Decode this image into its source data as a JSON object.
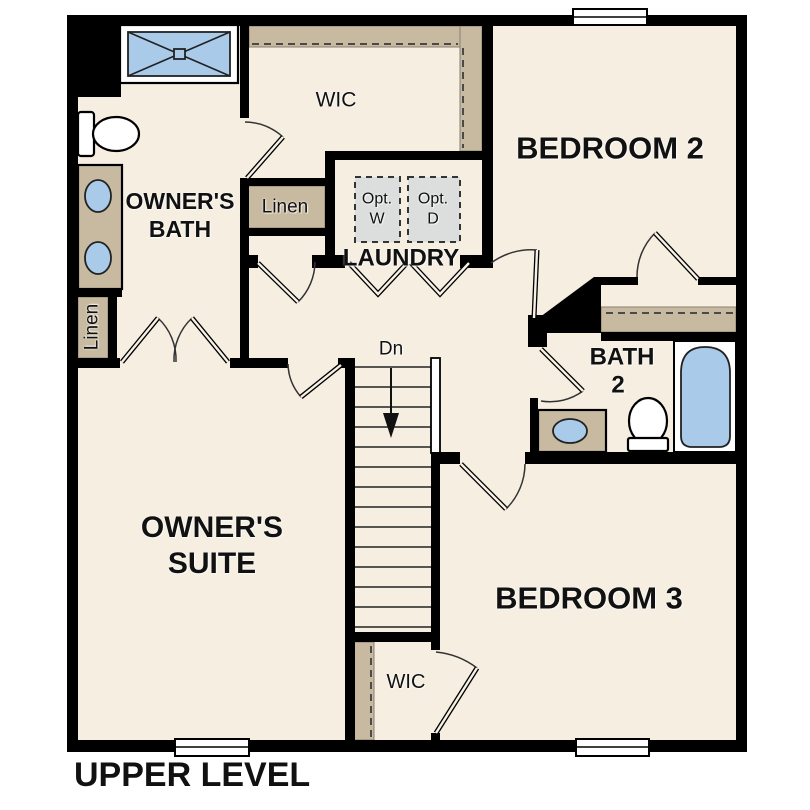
{
  "floor_plan": {
    "level_title": "UPPER LEVEL",
    "rooms": {
      "bedroom2": {
        "label": "BEDROOM 2"
      },
      "bedroom3": {
        "label": "BEDROOM 3"
      },
      "owners_suite": {
        "line1": "OWNER'S",
        "line2": "SUITE"
      },
      "owners_bath": {
        "line1": "OWNER'S",
        "line2": "BATH"
      },
      "bath2": {
        "line1": "BATH",
        "line2": "2"
      },
      "laundry": {
        "label": "LAUNDRY"
      },
      "wic_upper": {
        "label": "WIC"
      },
      "wic_lower": {
        "label": "WIC"
      },
      "linen_upper": {
        "label": "Linen"
      },
      "linen_lower": {
        "label": "Linen"
      }
    },
    "appliances": {
      "optional_washer": {
        "line1": "Opt.",
        "line2": "W"
      },
      "optional_dryer": {
        "line1": "Opt.",
        "line2": "D"
      }
    },
    "stairs": {
      "direction_label": "Dn"
    },
    "fixtures": [
      "shower",
      "toilet",
      "double-sink-vanity",
      "linen-shelves",
      "optional-washer-dryer",
      "sink-vanity",
      "bathtub",
      "closet-shelves",
      "windows",
      "stairs-down"
    ],
    "colors": {
      "bg": "#ffffff",
      "floor": "#f5eee1",
      "wall": "#000000",
      "shelf": "#c8baa0",
      "fixture_blue": "#a9cbe9",
      "appliance_gray": "#dcdedd",
      "ink": "#111111"
    }
  }
}
